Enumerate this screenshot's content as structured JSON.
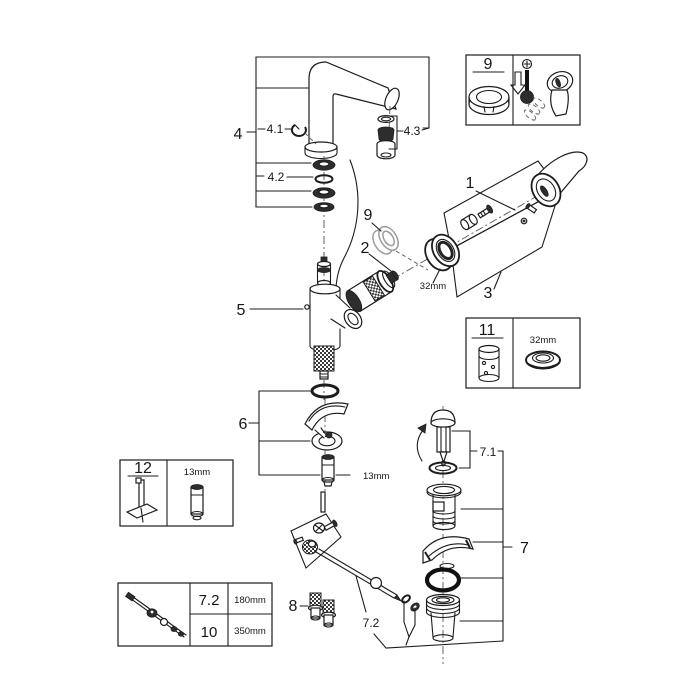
{
  "figure": {
    "kind": "exploded-parts-diagram"
  },
  "callouts": {
    "n1": "1",
    "n2": "2",
    "n3": "3",
    "n4": "4",
    "n4_1": "4.1",
    "n4_2": "4.2",
    "n4_3": "4.3",
    "n5": "5",
    "n6": "6",
    "n7": "7",
    "n7_1": "7.1",
    "n7_2": "7.2",
    "n8": "8",
    "n9": "9"
  },
  "measurements": {
    "cap_ring": "32mm",
    "mounting_stud": "13mm"
  },
  "insets": {
    "temp_limiter": {
      "number": "9"
    },
    "cartridge": {
      "number": "11",
      "ring_size": "32mm"
    },
    "mounting_tool": {
      "number": "12",
      "stud_size": "13mm"
    },
    "rod_lengths": {
      "rows": [
        {
          "ref": "7.2",
          "length": "180mm"
        },
        {
          "ref": "10",
          "length": "350mm"
        }
      ]
    }
  }
}
